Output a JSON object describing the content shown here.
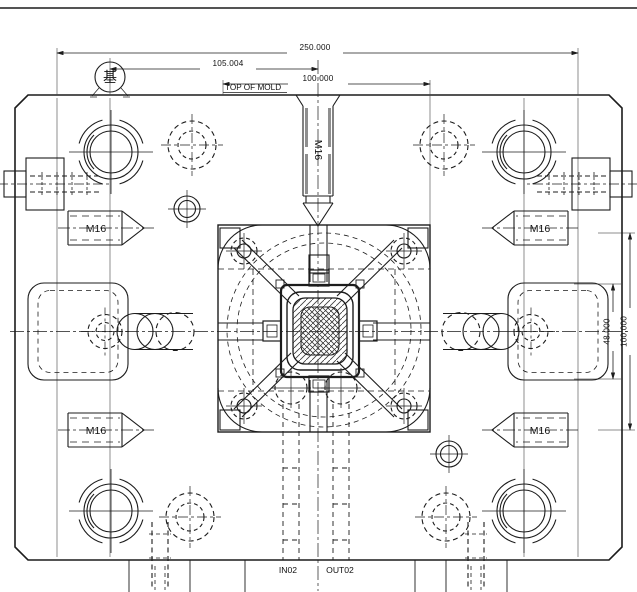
{
  "drawing": {
    "labels": {
      "datum": "基",
      "top_of_mold": "TOP OF MOLD",
      "thread_m16": "M16",
      "water_in": "IN02",
      "water_out": "OUT02"
    },
    "dimensions": {
      "overall_width": "250.000",
      "datum_offset": "105.004",
      "mold_width": "100.000",
      "pocket_height": "48.000",
      "side_spacing": "100.000"
    },
    "colors": {
      "line": "#1c1c1c",
      "background": "#ffffff"
    }
  }
}
